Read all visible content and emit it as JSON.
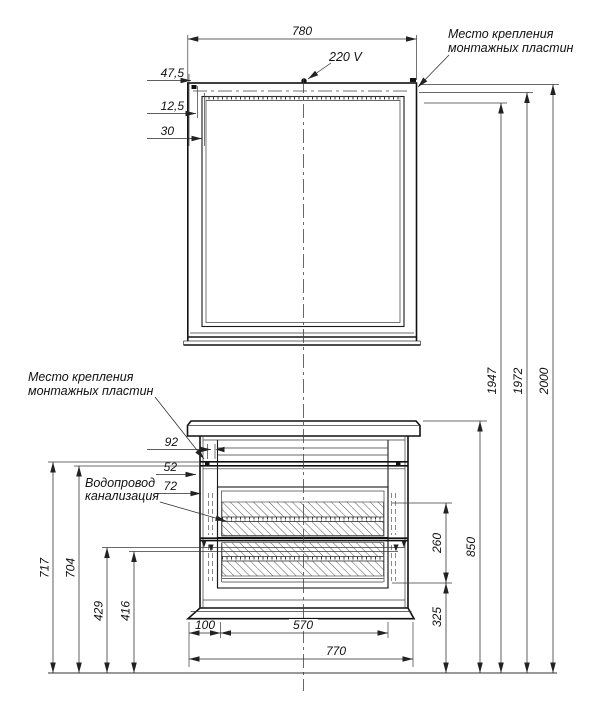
{
  "drawing": {
    "labels": {
      "voltage": "220 V",
      "mount_top_line1": "Место крепления",
      "mount_top_line2": "монтажных пластин",
      "mount_left_line1": "Место крепления",
      "mount_left_line2": "монтажных пластин",
      "water_line1": "Водопровод",
      "water_line2": "канализация"
    },
    "dims": {
      "mirror_width": "780",
      "offset_47_5": "47,5",
      "offset_12_5": "12,5",
      "offset_30": "30",
      "height_2000": "2000",
      "height_1972": "1972",
      "height_1947": "1947",
      "top_92": "92",
      "top_52": "52",
      "top_72": "72",
      "height_717": "717",
      "height_704": "704",
      "height_429": "429",
      "height_416": "416",
      "drawer_span_260": "260",
      "cabinet_height_850": "850",
      "clearance_325": "325",
      "offset_100": "100",
      "drawer_width_570": "570",
      "cabinet_width_770": "770"
    },
    "colors": {
      "ink": "#1a1a1a",
      "background": "#ffffff"
    }
  }
}
